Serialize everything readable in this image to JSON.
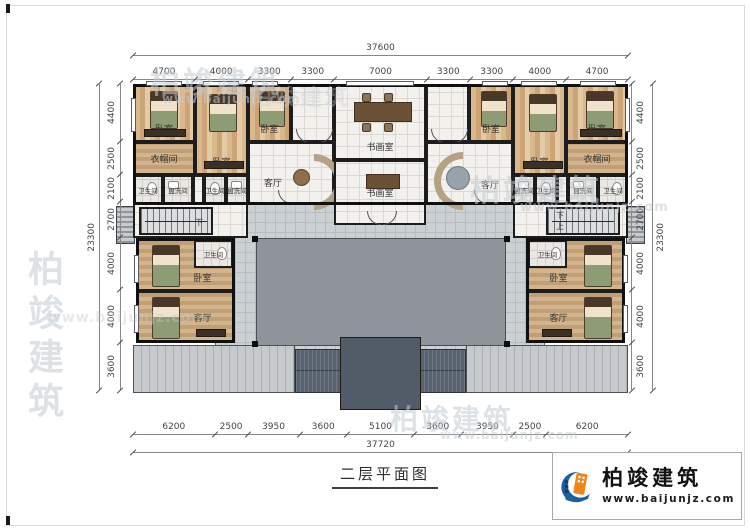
{
  "page": {
    "title_text": "二层平面图"
  },
  "logo": {
    "brand": "柏竣建筑",
    "url": "www.baijunjz.com"
  },
  "watermark": {
    "brand": "柏竣建筑",
    "url": "www.baijunjz.com"
  },
  "dims": {
    "top_total": "37600",
    "top_segments": [
      4700,
      4000,
      3300,
      3300,
      7000,
      3300,
      3300,
      4000,
      4700
    ],
    "bottom_total": "37720",
    "bottom_segments": [
      6200,
      2500,
      3950,
      3600,
      5100,
      3600,
      3950,
      2500,
      6200
    ],
    "left_total": "23300",
    "left_segments": [
      4400,
      2500,
      2100,
      2700,
      4000,
      4000,
      3600
    ],
    "right_total": "23300",
    "right_segments": [
      4400,
      2500,
      2100,
      2700,
      4000,
      4000,
      3600
    ]
  },
  "labels": {
    "bedroom": "卧室",
    "cloakroom": "衣帽间",
    "bathroom": "卫生间",
    "washroom": "盥洗间",
    "living_room": "客厅",
    "art_room": "书画室",
    "stairs_down": "下",
    "stairs_up": "上"
  }
}
